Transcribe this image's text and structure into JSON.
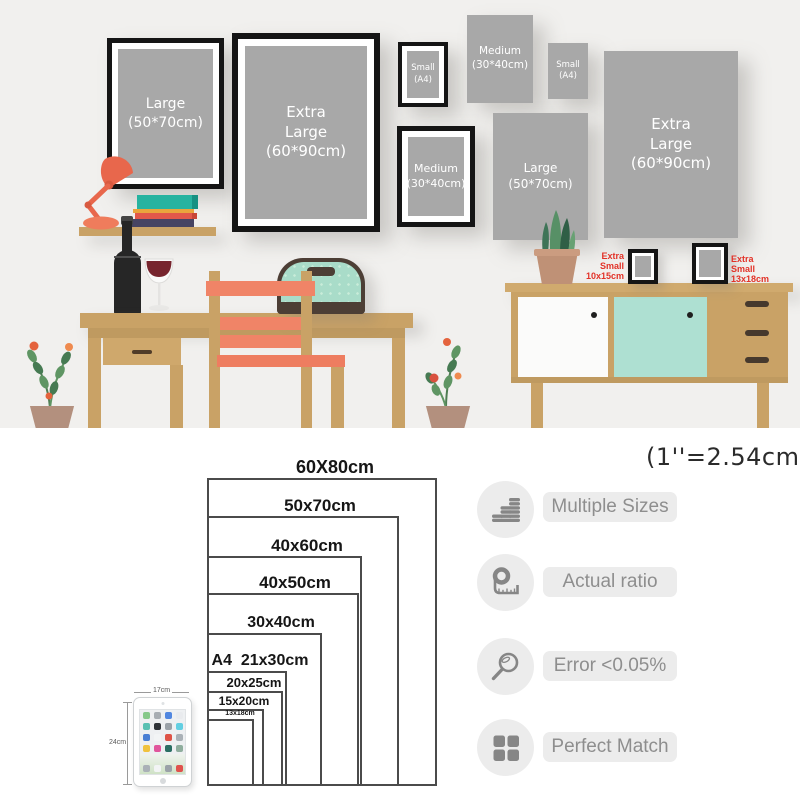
{
  "note": {
    "inch_conversion": "(1''=2.54cm)"
  },
  "scene": {
    "frames": [
      {
        "style": "framed",
        "l1": "Large",
        "l2": "(50*70cm)"
      },
      {
        "style": "framed",
        "l1": "Extra",
        "l2": "Large",
        "l3": "(60*90cm)"
      },
      {
        "style": "framed",
        "l1": "Small",
        "l2": "(A4)"
      },
      {
        "style": "plain",
        "l1": "Medium",
        "l2": "(30*40cm)"
      },
      {
        "style": "plain",
        "l1": "Small",
        "l2": "(A4)"
      },
      {
        "style": "framed",
        "l1": "Medium",
        "l2": "(30*40cm)"
      },
      {
        "style": "plain",
        "l1": "Large",
        "l2": "(50*70cm)"
      },
      {
        "style": "plain",
        "l1": "Extra",
        "l2": "Large",
        "l3": "(60*90cm)"
      }
    ],
    "extra_small_left": {
      "l1": "Extra",
      "l2": "Small",
      "l3": "10x15cm"
    },
    "extra_small_right": {
      "l1": "Extra",
      "l2": "Small",
      "l3": "13x18cm"
    }
  },
  "size_chart": {
    "sizes": [
      {
        "label": "60X80cm"
      },
      {
        "label": "50x70cm"
      },
      {
        "label": "40x60cm"
      },
      {
        "label": "40x50cm"
      },
      {
        "label": "30x40cm"
      },
      {
        "label": "A4  21x30cm"
      },
      {
        "label": "20x25cm"
      },
      {
        "label": "15x20cm"
      },
      {
        "label": "13x18cm"
      }
    ],
    "ipad": {
      "width_label": "17cm",
      "height_label": "24cm",
      "app_icon_colors": [
        "#86c98a",
        "#a7adb3",
        "#5187e0",
        "#e9ebee",
        "#58c0b2",
        "#2f3338",
        "#9aa1a8",
        "#63cfe2",
        "#4a7fd4",
        "#f2f4f5",
        "#de5347",
        "#aab1b7",
        "#f0c23e",
        "#e0559c",
        "#2a6e63",
        "#8fae9e"
      ],
      "dock_icon_colors": [
        "#aab1b7",
        "#f2f4f5",
        "#9aa1a8",
        "#e0524d"
      ]
    }
  },
  "features": [
    {
      "icon": "coins-icon",
      "label": "Multiple Sizes"
    },
    {
      "icon": "tape-measure-icon",
      "label": "Actual ratio"
    },
    {
      "icon": "magnifier-icon",
      "label": "Error <0.05%"
    },
    {
      "icon": "grid-icon",
      "label": "Perfect Match"
    }
  ],
  "colors": {
    "wall": "#f1f0ee",
    "wood": "#c9a266",
    "coral": "#f08467",
    "mint": "#abdfd2",
    "poster_gray": "#a8a8a8",
    "frame_black": "#151515",
    "accent_red": "#e23228"
  }
}
